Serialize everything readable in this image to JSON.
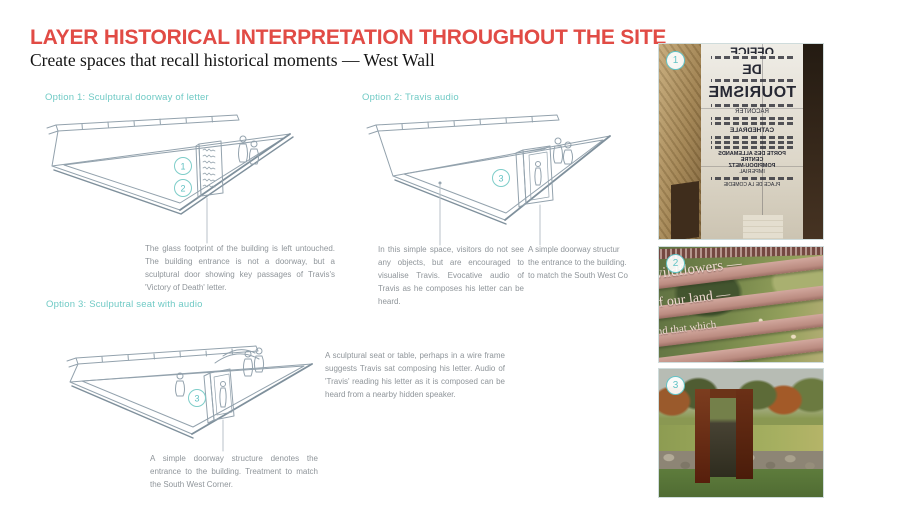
{
  "header": {
    "title": "LAYER HISTORICAL INTERPRETATION THROUGHOUT THE SITE",
    "subtitle": "Create spaces that recall historical moments — West Wall"
  },
  "colors": {
    "title_red": "#e14b45",
    "option_teal": "#70cac5",
    "caption_gray": "#8f959a",
    "sketch_line": "#93a2ad"
  },
  "options": [
    {
      "label": "Option 1: Sculptural doorway of letter",
      "markers": [
        "1",
        "2"
      ],
      "caption_below": "The glass footprint of the building is left untouched.  The building entrance is not a doorway, but a sculptural door showing key passages of Travis's 'Victory of Death' letter."
    },
    {
      "label": "Option 2: Travis audio",
      "markers": [
        "3"
      ],
      "caption_below": "In this simple space, visitors do not see any objects, but are encouraged to visualise Travis.  Evocative audio of Travis as he composes his letter can be heard.",
      "caption_right_lines": [
        "A simple doorway structur",
        "the entrance to the building.",
        "to match the South West Co"
      ]
    },
    {
      "label": "Option 3: Sculputral seat with audio",
      "markers": [
        "3"
      ],
      "caption_right": "A sculptural seat or table, perhaps in a wire frame suggests Travis sat composing his letter. Audio of 'Travis' reading his letter as it is composed can be heard from a nearby hidden speaker.",
      "caption_below": "A simple doorway structure denotes the entrance to the building. Treatment to match the South West Corner."
    }
  ],
  "photos": [
    {
      "number": "1",
      "description": "glass door with mirrored etched lettering",
      "glass_words": [
        "OFFICE",
        "DE",
        "TOURISME",
        "RACONTER",
        "CATHEDRALE",
        "PORTE DES ALLEMANDS",
        "CENTRE",
        "POMPIDOU-METZ",
        "IMPERIAL",
        "PLACE DE LA COMEDIE"
      ]
    },
    {
      "number": "2",
      "description": "cut-out text bands over wildflower planting",
      "band_words": [
        "wildflowers —",
        "of our land —",
        "and that which"
      ]
    },
    {
      "number": "3",
      "description": "corten steel doorway by stone wall in field"
    }
  ]
}
